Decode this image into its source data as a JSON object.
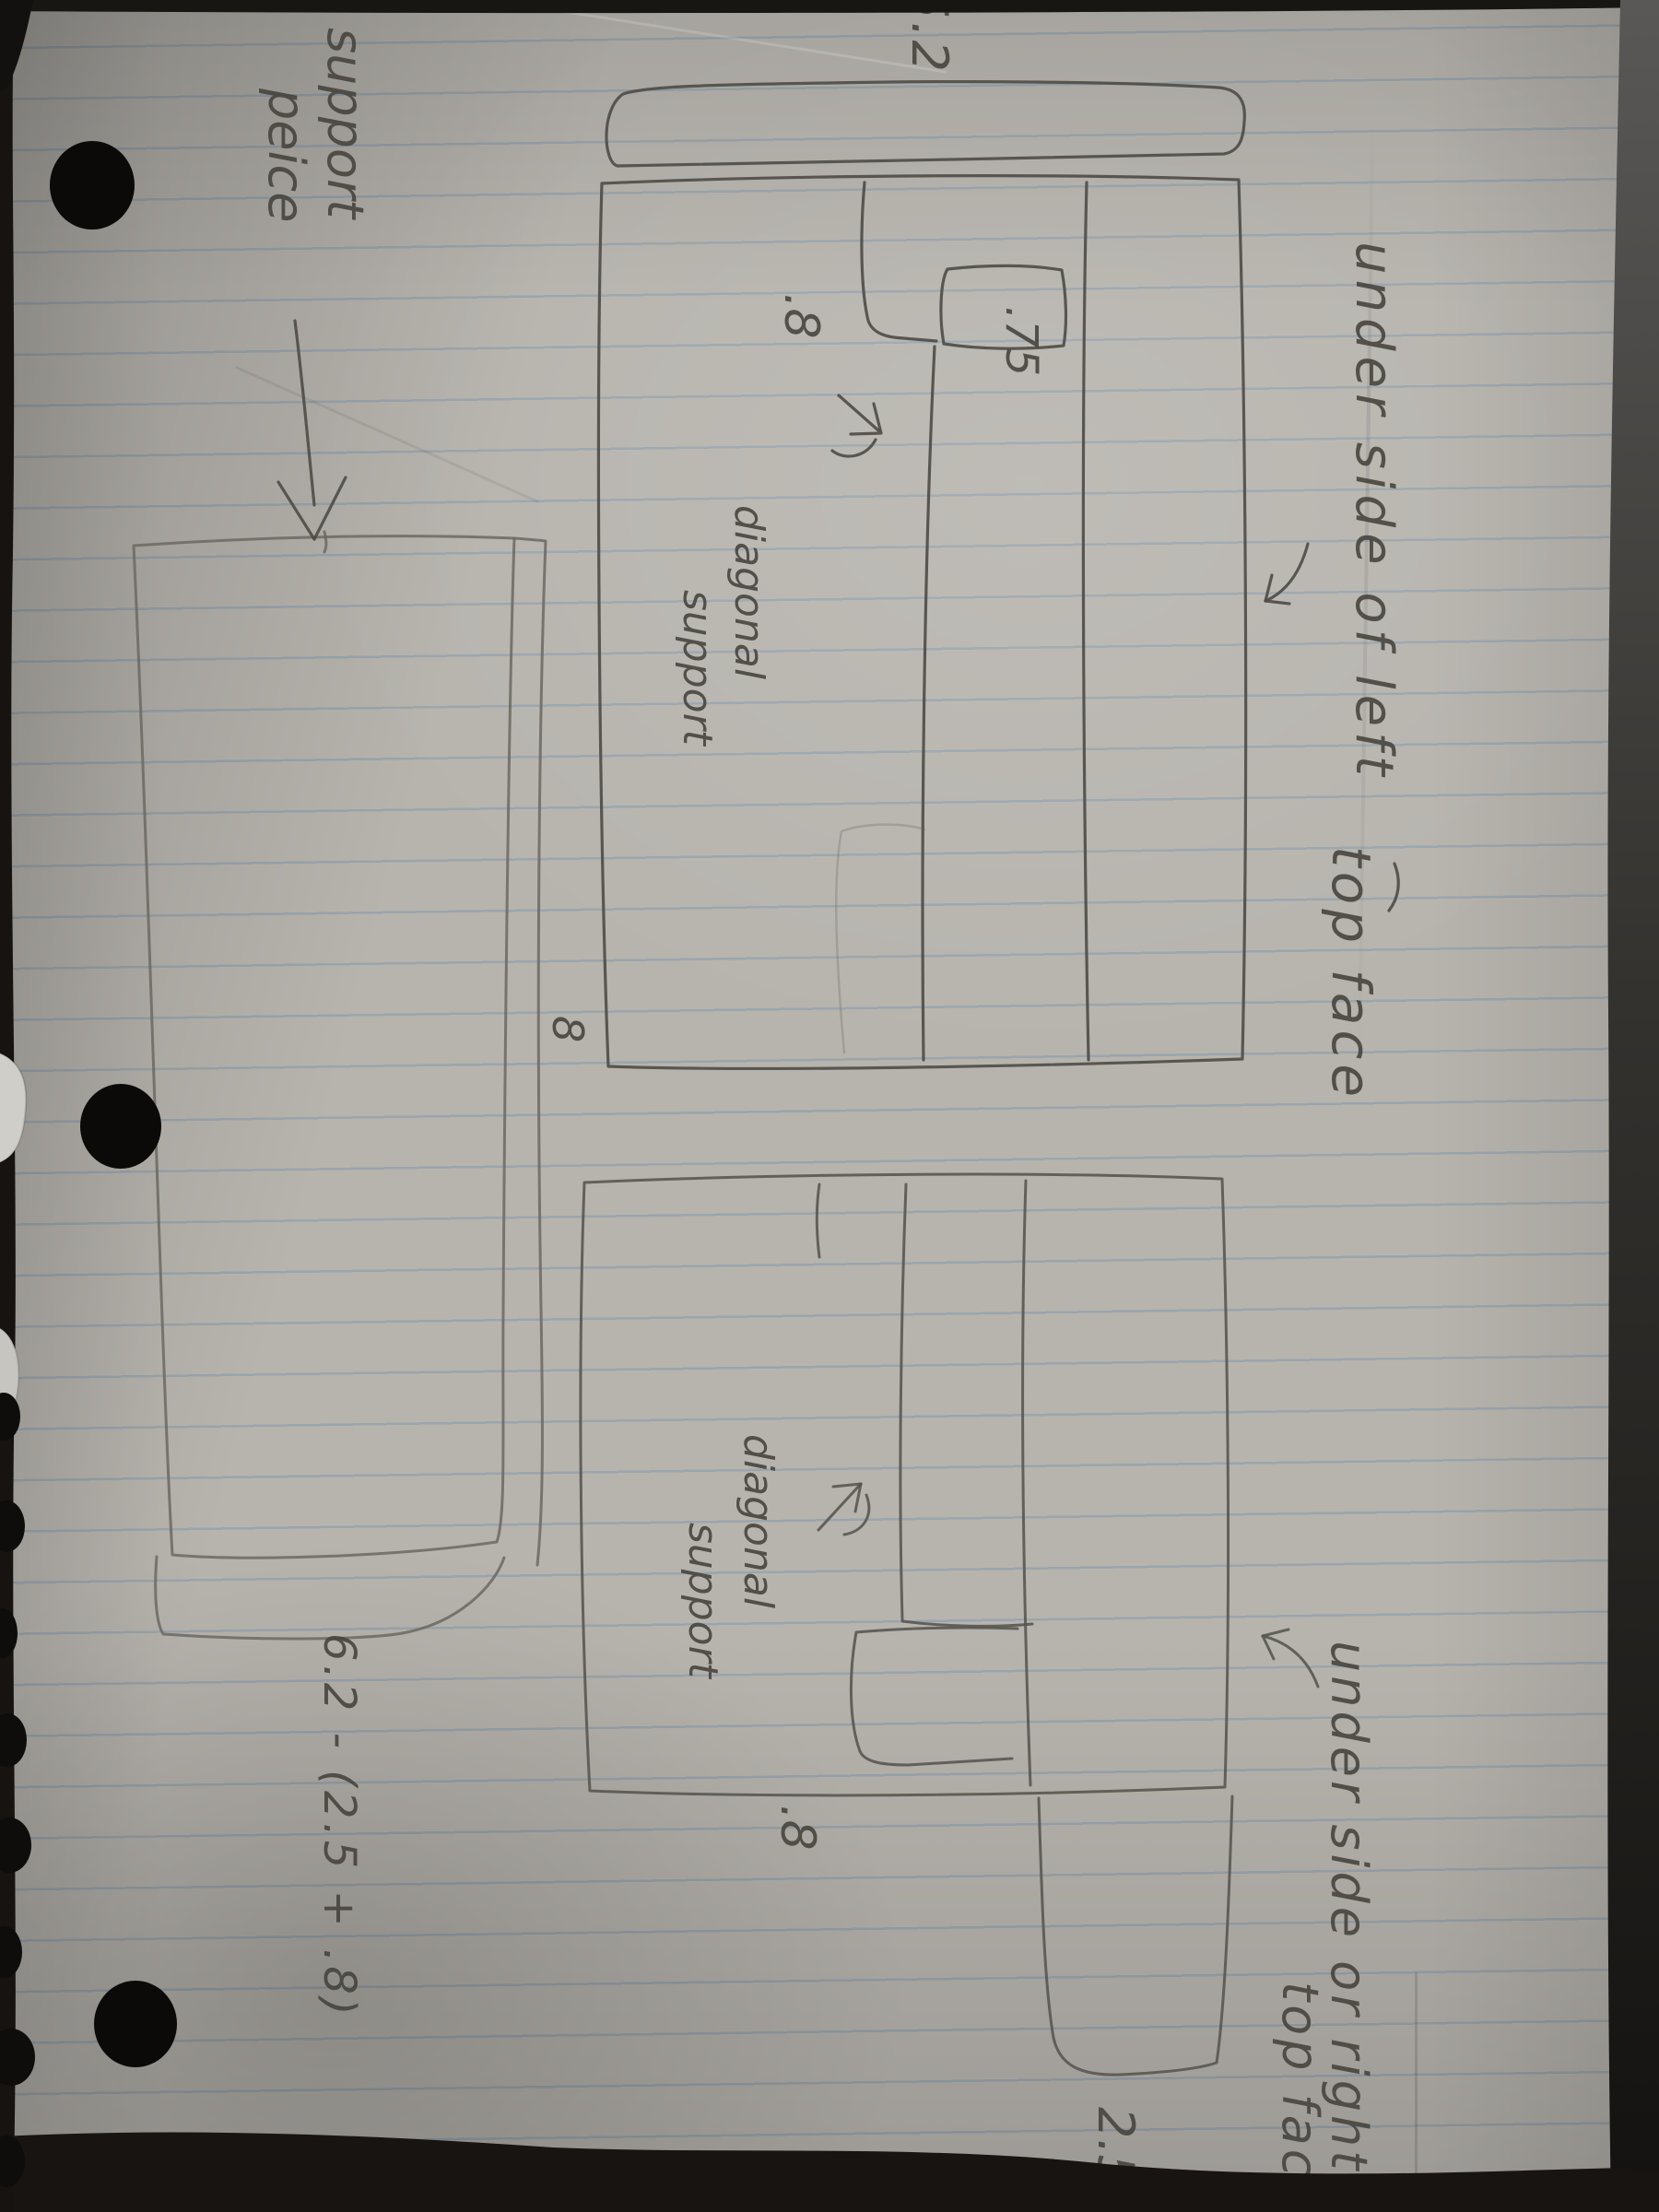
{
  "colors": {
    "background": "#17140f",
    "paper": "#b7b4ae",
    "rule_line": "#7d96ac",
    "pencil": "#4e4b46",
    "pencil_text": "#45423c",
    "hole": "#0b0a09"
  },
  "annotations": {
    "top_drawing": {
      "title_line1": "under side of left",
      "title_line2": "top face",
      "dim_top_length": "5.2",
      "dim_notch_depth": ".8",
      "dim_notch_width": ".75",
      "dim_corner": "8",
      "label_line1": "diagonal",
      "label_line2": "support"
    },
    "bottom_drawing": {
      "title_line1": "under side or right",
      "title_line2": "top face",
      "dim_notch_depth": ".8",
      "dim_tab": "2.5",
      "label_line1": "diagonal",
      "label_line2": "support"
    },
    "support_piece": {
      "label_line1": "support",
      "label_line2": "peice",
      "formula": "6.2 - (2.5 + .8)"
    }
  }
}
